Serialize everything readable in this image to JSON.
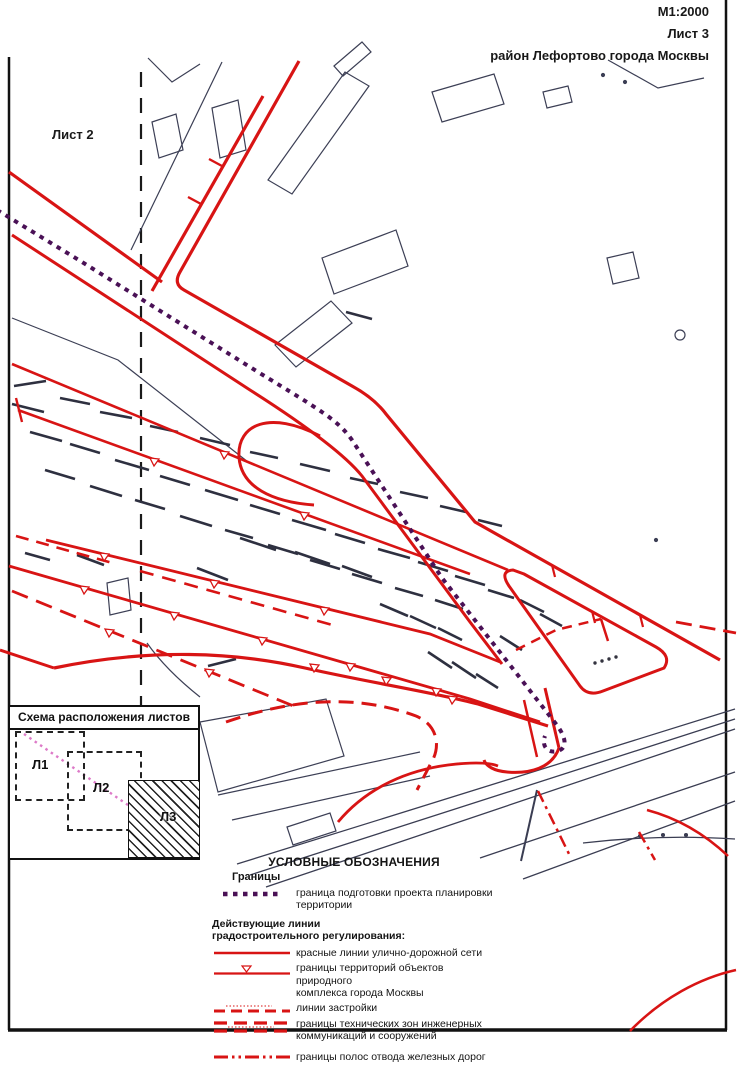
{
  "header": {
    "scale": "М1:2000",
    "sheet": "Лист 3",
    "region": "район Лефортово города Москвы"
  },
  "map": {
    "adjacent_sheet_label": "Лист 2"
  },
  "inset": {
    "title": "Схема расположения листов",
    "sheets": [
      {
        "label": "Л1"
      },
      {
        "label": "Л2"
      },
      {
        "label": "Л3",
        "style": "hatched-current-sheet"
      }
    ]
  },
  "legend": {
    "title": "УСЛОВНЫЕ ОБОЗНАЧЕНИЯ",
    "groups": [
      {
        "heading": "Границы",
        "items": [
          {
            "symbol": "purple-dotted-line",
            "label": "граница подготовки проекта планировки\nтерритории"
          }
        ]
      },
      {
        "heading": "Действующие линии\nградостроительного регулирования:",
        "items": [
          {
            "symbol": "red-solid-line",
            "label": "красные линии улично-дорожной сети"
          },
          {
            "symbol": "red-line-triangle-marker",
            "label": "границы территорий объектов природного\nкомплекса города Москвы"
          },
          {
            "symbol": "red-dashed-line",
            "label": "линии застройки"
          },
          {
            "symbol": "red-double-dashed-line",
            "label": "границы технических зон инженерных\nкоммуникаций и сооружений"
          },
          {
            "symbol": "red-dash-dot-dot-line",
            "label": "границы полос отвода железных дорог"
          }
        ]
      }
    ]
  },
  "colors": {
    "map_red": "#d81414",
    "boundary_purple": "#4a1156",
    "inset_pink": "#dd7ac8",
    "linework_black": "#2e3040"
  }
}
